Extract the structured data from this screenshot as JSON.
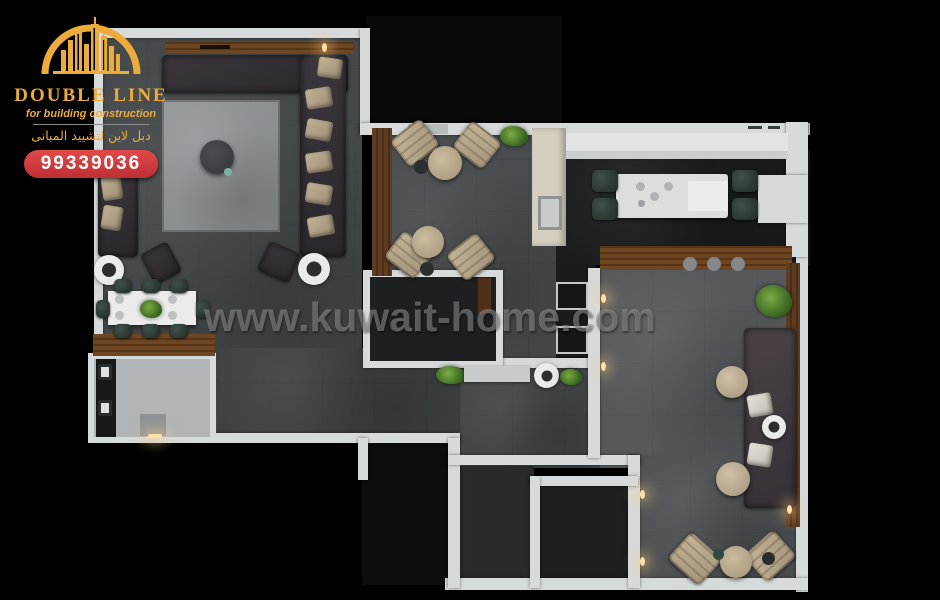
{
  "brand": {
    "logo_title": "DOUBLE LINE",
    "logo_subtitle": "for building construction",
    "logo_arabic": "دبل لاين لتشييد المبانى",
    "phone": "99339036"
  },
  "watermark": "www.kuwait-home.com",
  "colors": {
    "brand_gold": "#ECAC3C",
    "phone_red": "#D63A3F",
    "wall_white": "#D7DADB",
    "background_black": "#000000"
  }
}
